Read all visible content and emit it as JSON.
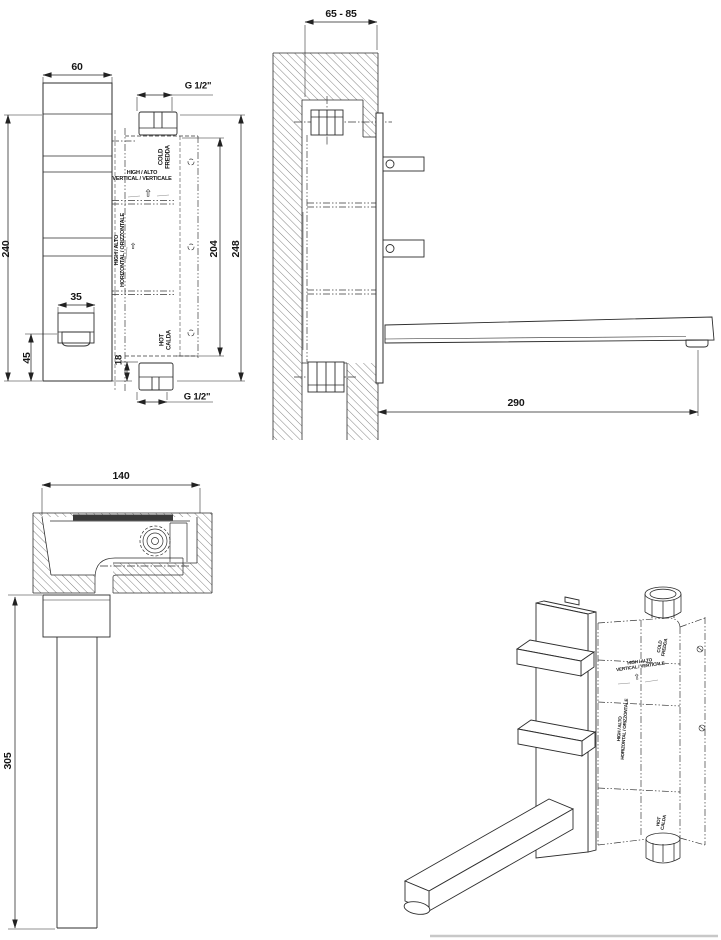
{
  "labels": {
    "high_alto": "HIGH / ALTO",
    "vertical": "VERTICAL / VERTICALE",
    "horizontal": "HORIZONTAL / ORIZZONTALE",
    "cold_en": "COLD",
    "cold_it": "FREDDA",
    "hot_en": "HOT",
    "hot_it": "CALDA",
    "thread_size": "G 1/2\"",
    "up_arrow": "⇧"
  },
  "dimensions": {
    "front_plate_width": "60",
    "front_plate_height": "240",
    "spout_width": "35",
    "spout_to_bottom": "45",
    "hot_inlet_offset": "18",
    "rough_in_height": "204",
    "overall_height": "248",
    "wall_depth_range": "65 - 85",
    "spout_reach_side": "290",
    "rough_in_depth": "140",
    "spout_reach_plan": "305"
  }
}
